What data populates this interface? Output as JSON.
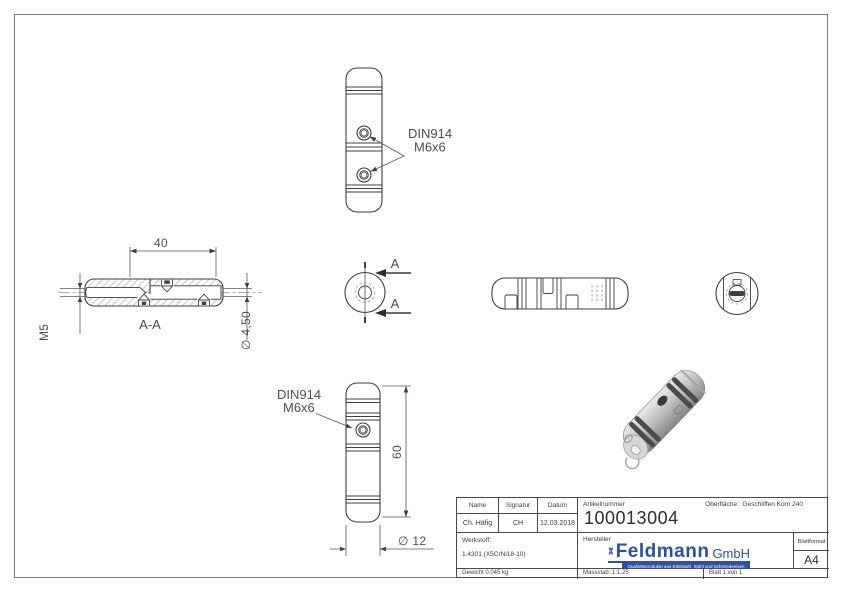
{
  "drawing": {
    "top_view": {
      "callout_line1": "DIN914",
      "callout_line2": "M6x6"
    },
    "section_view": {
      "dim_length": "40",
      "label": "A-A",
      "thread_callout": "M5",
      "diameter_callout": "∅ 4,50"
    },
    "cut_indicator": {
      "label_top": "A",
      "label_bottom": "A"
    },
    "front_view": {
      "callout_line1": "DIN914",
      "callout_line2": "M6x6",
      "dim_length": "60",
      "diameter_callout": "∅ 12"
    }
  },
  "title_block": {
    "header": {
      "name": "Name",
      "signatur": "Signatur",
      "datum": "Datum"
    },
    "values": {
      "name": "Ch. Häfig",
      "signatur": "CH",
      "datum": "12.03.2018"
    },
    "artikelnummer_label": "Artikelnummer",
    "artikelnummer": "100013004",
    "oberflaeche_label": "Oberfläche:",
    "oberflaeche_value": "Geschliffen Korn 240",
    "werkstoff_label": "Werkstoff:",
    "werkstoff_value": "1.4301 (X5CrNi18-10)",
    "hersteller_label": "Hersteller",
    "logo": {
      "brand": "Feldmann",
      "suffix": "GmbH",
      "tagline": "Qualitätsprodukte aus Edelstahl, Stahl und Schmiedeeisen"
    },
    "blattformat_label": "Blattformat",
    "blattformat_value": "A4",
    "gewicht": "Gewicht 0.045 kg",
    "massstab": "Massstab: 1:1.25",
    "blatt": "Blatt 1 von 1"
  },
  "colors": {
    "logo_blue": "#2a52a4",
    "line": "#3f3f3f"
  }
}
